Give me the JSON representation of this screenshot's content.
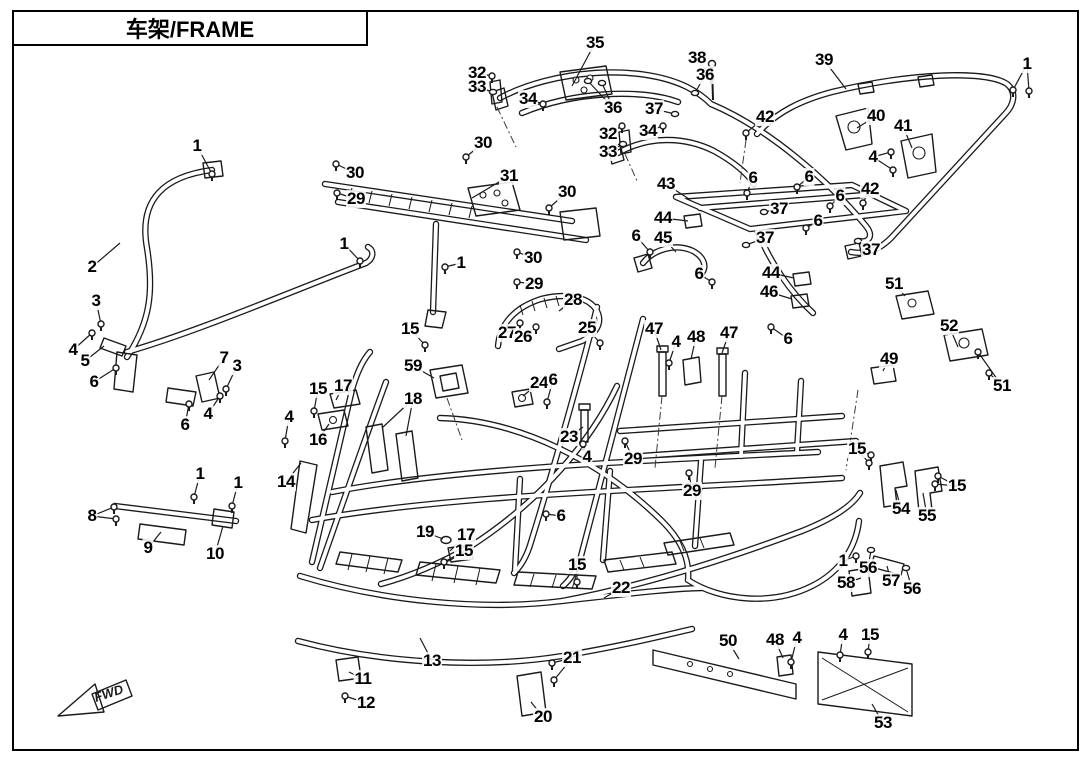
{
  "page": {
    "title": "车架/FRAME",
    "fwd_label": "FWD"
  },
  "callouts": [
    {
      "n": "1",
      "x": 197,
      "y": 146,
      "tx": 212,
      "ty": 174,
      "g": "bolt"
    },
    {
      "n": "2",
      "x": 92,
      "y": 267,
      "tx": 120,
      "ty": 243,
      "g": "none"
    },
    {
      "n": "3",
      "x": 96,
      "y": 301,
      "tx": 101,
      "ty": 324,
      "g": "bolt"
    },
    {
      "n": "4",
      "x": 73,
      "y": 350,
      "tx": 92,
      "ty": 333,
      "g": "bolt"
    },
    {
      "n": "5",
      "x": 85,
      "y": 361,
      "tx": 104,
      "ty": 346,
      "g": "none"
    },
    {
      "n": "6",
      "x": 94,
      "y": 382,
      "tx": 116,
      "ty": 368,
      "g": "bolt"
    },
    {
      "n": "6",
      "x": 185,
      "y": 425,
      "tx": 189,
      "ty": 404,
      "g": "bolt"
    },
    {
      "n": "7",
      "x": 224,
      "y": 358,
      "tx": 209,
      "ty": 380,
      "g": "none"
    },
    {
      "n": "3",
      "x": 237,
      "y": 366,
      "tx": 226,
      "ty": 389,
      "g": "bolt"
    },
    {
      "n": "4",
      "x": 208,
      "y": 414,
      "tx": 220,
      "ty": 396,
      "g": "bolt"
    },
    {
      "n": "8",
      "x": 92,
      "y": 516,
      "tx": 114,
      "ty": 507,
      "tx2": 116,
      "ty2": 519,
      "g": "bolt"
    },
    {
      "n": "9",
      "x": 148,
      "y": 548,
      "tx": 161,
      "ty": 532,
      "g": "none"
    },
    {
      "n": "10",
      "x": 215,
      "y": 554,
      "tx": 223,
      "ty": 526,
      "g": "none"
    },
    {
      "n": "1",
      "x": 200,
      "y": 474,
      "tx": 194,
      "ty": 497,
      "g": "bolt"
    },
    {
      "n": "1",
      "x": 238,
      "y": 483,
      "tx": 232,
      "ty": 506,
      "g": "bolt"
    },
    {
      "n": "30",
      "x": 355,
      "y": 173,
      "tx": 336,
      "ty": 164,
      "g": "bolt"
    },
    {
      "n": "29",
      "x": 356,
      "y": 199,
      "tx": 337,
      "ty": 193,
      "g": "bolt"
    },
    {
      "n": "30",
      "x": 483,
      "y": 143,
      "tx": 466,
      "ty": 157,
      "g": "bolt"
    },
    {
      "n": "31",
      "x": 509,
      "y": 176,
      "tx": 472,
      "ty": 198,
      "g": "none"
    },
    {
      "n": "30",
      "x": 567,
      "y": 192,
      "tx": 549,
      "ty": 208,
      "g": "bolt"
    },
    {
      "n": "1",
      "x": 344,
      "y": 244,
      "tx": 360,
      "ty": 261,
      "g": "bolt"
    },
    {
      "n": "1",
      "x": 461,
      "y": 263,
      "tx": 445,
      "ty": 267,
      "g": "bolt"
    },
    {
      "n": "30",
      "x": 533,
      "y": 258,
      "tx": 517,
      "ty": 252,
      "g": "bolt"
    },
    {
      "n": "29",
      "x": 534,
      "y": 284,
      "tx": 517,
      "ty": 282,
      "g": "bolt"
    },
    {
      "n": "35",
      "x": 595,
      "y": 43,
      "tx": 572,
      "ty": 86,
      "g": "none"
    },
    {
      "n": "32",
      "x": 477,
      "y": 73,
      "tx": 492,
      "ty": 76,
      "g": "bolt"
    },
    {
      "n": "33",
      "x": 477,
      "y": 87,
      "tx": 493,
      "ty": 92,
      "g": "nut"
    },
    {
      "n": "34",
      "x": 528,
      "y": 99,
      "tx": 543,
      "ty": 104,
      "g": "bolt"
    },
    {
      "n": "36",
      "x": 613,
      "y": 108,
      "tx": 588,
      "ty": 81,
      "tx2": 602,
      "ty2": 83,
      "g": "nut"
    },
    {
      "n": "38",
      "x": 697,
      "y": 58,
      "tx": 711,
      "ty": 77,
      "g": "bolt"
    },
    {
      "n": "36",
      "x": 705,
      "y": 75,
      "tx": 695,
      "ty": 93,
      "g": "nut"
    },
    {
      "n": "37",
      "x": 654,
      "y": 109,
      "tx": 675,
      "ty": 114,
      "g": "nut"
    },
    {
      "n": "34",
      "x": 648,
      "y": 131,
      "tx": 663,
      "ty": 126,
      "g": "bolt"
    },
    {
      "n": "32",
      "x": 608,
      "y": 134,
      "tx": 622,
      "ty": 126,
      "g": "bolt"
    },
    {
      "n": "33",
      "x": 608,
      "y": 152,
      "tx": 623,
      "ty": 144,
      "g": "nut"
    },
    {
      "n": "39",
      "x": 824,
      "y": 60,
      "tx": 846,
      "ty": 89,
      "g": "none"
    },
    {
      "n": "1",
      "x": 1027,
      "y": 64,
      "tx": 1013,
      "ty": 90,
      "tx2": 1029,
      "ty2": 91,
      "g": "bolt"
    },
    {
      "n": "42",
      "x": 765,
      "y": 117,
      "tx": 746,
      "ty": 133,
      "g": "bolt"
    },
    {
      "n": "40",
      "x": 876,
      "y": 116,
      "tx": 857,
      "ty": 128,
      "g": "none"
    },
    {
      "n": "41",
      "x": 903,
      "y": 126,
      "tx": 912,
      "ty": 148,
      "g": "none"
    },
    {
      "n": "4",
      "x": 873,
      "y": 157,
      "tx": 891,
      "ty": 152,
      "tx2": 893,
      "ty2": 170,
      "g": "bolt"
    },
    {
      "n": "42",
      "x": 870,
      "y": 189,
      "tx": 863,
      "ty": 203,
      "g": "bolt"
    },
    {
      "n": "43",
      "x": 666,
      "y": 184,
      "tx": 689,
      "ty": 199,
      "g": "none"
    },
    {
      "n": "6",
      "x": 753,
      "y": 178,
      "tx": 747,
      "ty": 193,
      "g": "bolt"
    },
    {
      "n": "6",
      "x": 809,
      "y": 177,
      "tx": 797,
      "ty": 187,
      "g": "bolt"
    },
    {
      "n": "6",
      "x": 840,
      "y": 196,
      "tx": 830,
      "ty": 206,
      "g": "bolt"
    },
    {
      "n": "6",
      "x": 818,
      "y": 221,
      "tx": 806,
      "ty": 228,
      "g": "bolt"
    },
    {
      "n": "37",
      "x": 779,
      "y": 209,
      "tx": 764,
      "ty": 212,
      "g": "nut"
    },
    {
      "n": "37",
      "x": 765,
      "y": 238,
      "tx": 746,
      "ty": 245,
      "g": "nut"
    },
    {
      "n": "37",
      "x": 871,
      "y": 250,
      "tx": 858,
      "ty": 241,
      "g": "nut"
    },
    {
      "n": "44",
      "x": 663,
      "y": 218,
      "tx": 688,
      "ty": 221,
      "g": "none"
    },
    {
      "n": "45",
      "x": 663,
      "y": 238,
      "tx": 676,
      "ty": 252,
      "g": "none"
    },
    {
      "n": "6",
      "x": 636,
      "y": 236,
      "tx": 650,
      "ty": 252,
      "g": "bolt"
    },
    {
      "n": "6",
      "x": 699,
      "y": 274,
      "tx": 712,
      "ty": 282,
      "g": "bolt"
    },
    {
      "n": "44",
      "x": 771,
      "y": 273,
      "tx": 794,
      "ty": 278,
      "g": "none"
    },
    {
      "n": "46",
      "x": 769,
      "y": 292,
      "tx": 792,
      "ty": 299,
      "g": "none"
    },
    {
      "n": "51",
      "x": 894,
      "y": 284,
      "tx": 905,
      "ty": 296,
      "g": "none"
    },
    {
      "n": "52",
      "x": 949,
      "y": 326,
      "tx": 958,
      "ty": 347,
      "g": "none"
    },
    {
      "n": "49",
      "x": 889,
      "y": 359,
      "tx": 883,
      "ty": 371,
      "g": "none"
    },
    {
      "n": "51",
      "x": 1002,
      "y": 386,
      "tx": 989,
      "ty": 373,
      "tx2": 978,
      "ty2": 352,
      "g": "bolt"
    },
    {
      "n": "15",
      "x": 857,
      "y": 449,
      "tx": 871,
      "ty": 455,
      "tx2": 869,
      "ty2": 463,
      "g": "bolt"
    },
    {
      "n": "15",
      "x": 957,
      "y": 486,
      "tx": 938,
      "ty": 476,
      "tx2": 935,
      "ty2": 484,
      "g": "bolt"
    },
    {
      "n": "54",
      "x": 901,
      "y": 509,
      "tx": 896,
      "ty": 490,
      "g": "none"
    },
    {
      "n": "55",
      "x": 927,
      "y": 516,
      "tx": 923,
      "ty": 493,
      "g": "none"
    },
    {
      "n": "1",
      "x": 843,
      "y": 561,
      "tx": 856,
      "ty": 556,
      "g": "bolt"
    },
    {
      "n": "58",
      "x": 846,
      "y": 583,
      "tx": 861,
      "ty": 578,
      "g": "none"
    },
    {
      "n": "56",
      "x": 868,
      "y": 568,
      "tx": 871,
      "ty": 550,
      "g": "nut"
    },
    {
      "n": "57",
      "x": 891,
      "y": 581,
      "tx": 887,
      "ty": 566,
      "g": "none"
    },
    {
      "n": "56",
      "x": 912,
      "y": 589,
      "tx": 906,
      "ty": 568,
      "g": "nut"
    },
    {
      "n": "28",
      "x": 573,
      "y": 300,
      "tx": 559,
      "ty": 311,
      "g": "none"
    },
    {
      "n": "27",
      "x": 507,
      "y": 333,
      "tx": 520,
      "ty": 323,
      "g": "bolt"
    },
    {
      "n": "26",
      "x": 523,
      "y": 337,
      "tx": 536,
      "ty": 327,
      "g": "bolt"
    },
    {
      "n": "25",
      "x": 587,
      "y": 328,
      "tx": 600,
      "ty": 343,
      "g": "bolt"
    },
    {
      "n": "15",
      "x": 410,
      "y": 329,
      "tx": 425,
      "ty": 345,
      "g": "bolt"
    },
    {
      "n": "59",
      "x": 413,
      "y": 366,
      "tx": 434,
      "ty": 378,
      "g": "none"
    },
    {
      "n": "15",
      "x": 318,
      "y": 389,
      "tx": 314,
      "ty": 411,
      "g": "bolt"
    },
    {
      "n": "17",
      "x": 343,
      "y": 386,
      "tx": 336,
      "ty": 400,
      "g": "none"
    },
    {
      "n": "18",
      "x": 413,
      "y": 399,
      "tx": 382,
      "ty": 428,
      "tx2": 406,
      "ty2": 436,
      "g": "none"
    },
    {
      "n": "4",
      "x": 289,
      "y": 417,
      "tx": 285,
      "ty": 441,
      "g": "bolt"
    },
    {
      "n": "16",
      "x": 318,
      "y": 440,
      "tx": 329,
      "ty": 424,
      "g": "none"
    },
    {
      "n": "14",
      "x": 286,
      "y": 482,
      "tx": 301,
      "ty": 463,
      "g": "none"
    },
    {
      "n": "24",
      "x": 539,
      "y": 383,
      "tx": 523,
      "ty": 396,
      "g": "none"
    },
    {
      "n": "6",
      "x": 553,
      "y": 380,
      "tx": 547,
      "ty": 402,
      "g": "bolt"
    },
    {
      "n": "23",
      "x": 569,
      "y": 437,
      "tx": 583,
      "ty": 427,
      "g": "none"
    },
    {
      "n": "4",
      "x": 587,
      "y": 457,
      "tx": 583,
      "ty": 444,
      "g": "bolt"
    },
    {
      "n": "29",
      "x": 633,
      "y": 459,
      "tx": 625,
      "ty": 441,
      "g": "bolt"
    },
    {
      "n": "29",
      "x": 692,
      "y": 491,
      "tx": 689,
      "ty": 473,
      "g": "bolt"
    },
    {
      "n": "47",
      "x": 654,
      "y": 329,
      "tx": 661,
      "ty": 350,
      "g": "none"
    },
    {
      "n": "4",
      "x": 676,
      "y": 342,
      "tx": 669,
      "ty": 363,
      "g": "bolt"
    },
    {
      "n": "48",
      "x": 696,
      "y": 337,
      "tx": 691,
      "ty": 359,
      "g": "none"
    },
    {
      "n": "47",
      "x": 729,
      "y": 333,
      "tx": 722,
      "ty": 353,
      "g": "none"
    },
    {
      "n": "6",
      "x": 788,
      "y": 339,
      "tx": 771,
      "ty": 327,
      "g": "bolt"
    },
    {
      "n": "19",
      "x": 425,
      "y": 532,
      "tx": 443,
      "ty": 539,
      "g": "none"
    },
    {
      "n": "17",
      "x": 466,
      "y": 535,
      "tx": 450,
      "ty": 551,
      "g": "none"
    },
    {
      "n": "15",
      "x": 464,
      "y": 551,
      "tx": 444,
      "ty": 562,
      "g": "bolt"
    },
    {
      "n": "6",
      "x": 561,
      "y": 516,
      "tx": 546,
      "ty": 514,
      "g": "bolt"
    },
    {
      "n": "15",
      "x": 577,
      "y": 565,
      "tx": 577,
      "ty": 582,
      "g": "bolt"
    },
    {
      "n": "22",
      "x": 621,
      "y": 588,
      "tx": 604,
      "ty": 598,
      "g": "none"
    },
    {
      "n": "13",
      "x": 432,
      "y": 661,
      "tx": 420,
      "ty": 638,
      "g": "none"
    },
    {
      "n": "11",
      "x": 363,
      "y": 679,
      "tx": 349,
      "ty": 672,
      "g": "none"
    },
    {
      "n": "12",
      "x": 366,
      "y": 703,
      "tx": 345,
      "ty": 696,
      "g": "bolt"
    },
    {
      "n": "20",
      "x": 543,
      "y": 717,
      "tx": 531,
      "ty": 702,
      "g": "none"
    },
    {
      "n": "21",
      "x": 572,
      "y": 658,
      "tx": 552,
      "ty": 663,
      "tx2": 554,
      "ty2": 680,
      "g": "bolt"
    },
    {
      "n": "50",
      "x": 728,
      "y": 641,
      "tx": 739,
      "ty": 659,
      "g": "none"
    },
    {
      "n": "48",
      "x": 775,
      "y": 640,
      "tx": 783,
      "ty": 658,
      "g": "none"
    },
    {
      "n": "4",
      "x": 797,
      "y": 638,
      "tx": 791,
      "ty": 662,
      "g": "bolt"
    },
    {
      "n": "4",
      "x": 843,
      "y": 635,
      "tx": 840,
      "ty": 655,
      "g": "bolt"
    },
    {
      "n": "15",
      "x": 870,
      "y": 635,
      "tx": 868,
      "ty": 652,
      "g": "bolt"
    },
    {
      "n": "53",
      "x": 883,
      "y": 723,
      "tx": 872,
      "ty": 704,
      "g": "none"
    }
  ]
}
